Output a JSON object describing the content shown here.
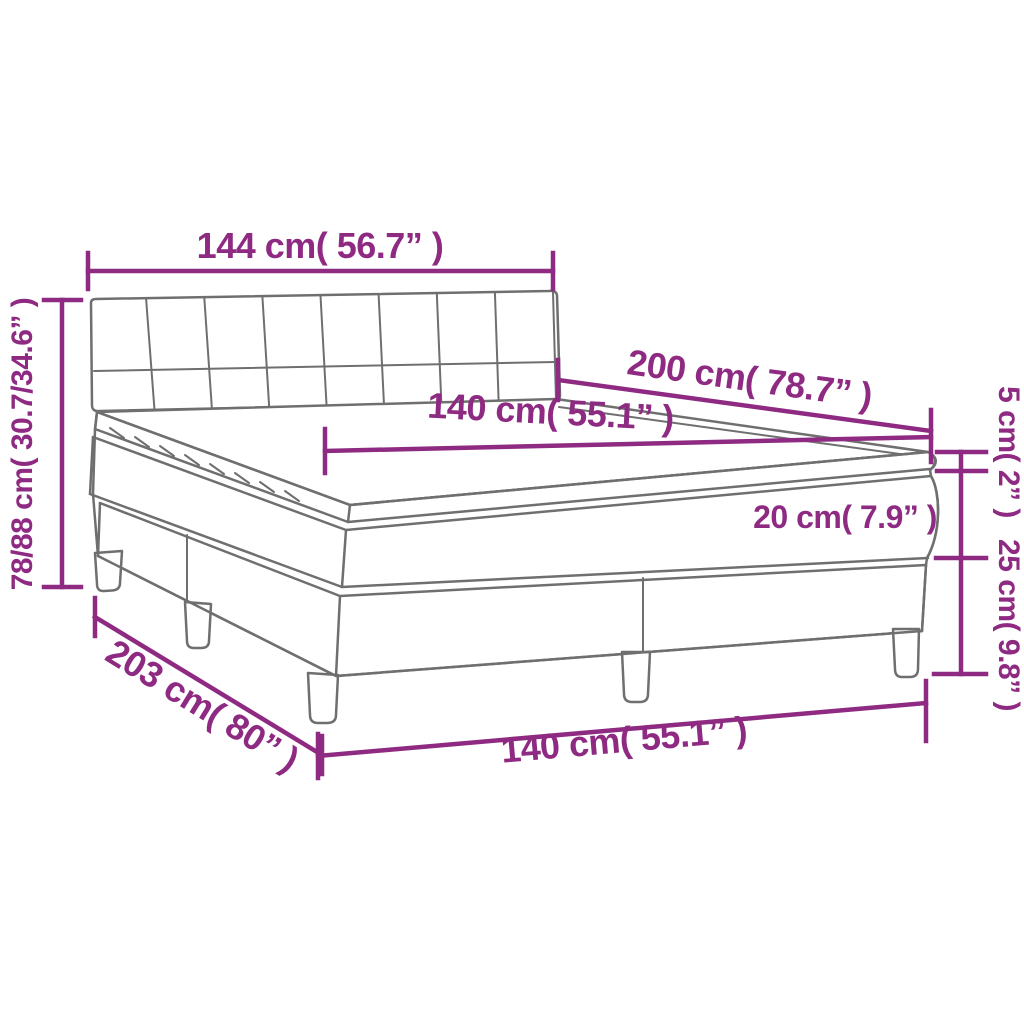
{
  "diagram": {
    "title": "box-spring-bed-dimension-diagram",
    "accent_color": "#8e2a82",
    "outline_color": "#6f6f6f",
    "background_color": "#ffffff",
    "dimensions": {
      "headboard_width": "144 cm( 56.7” )",
      "total_height": "78/88 cm( 30.7/34.6” )",
      "length": "200 cm( 78.7” )",
      "width_top": "140 cm( 55.1” )",
      "topper_height": "5 cm( 2” )",
      "mattress_height": "20 cm( 7.9” )",
      "base_height": "25 cm( 9.8” )",
      "total_length": "203 cm( 80” )",
      "width_bottom": "140 cm( 55.1” )"
    }
  }
}
